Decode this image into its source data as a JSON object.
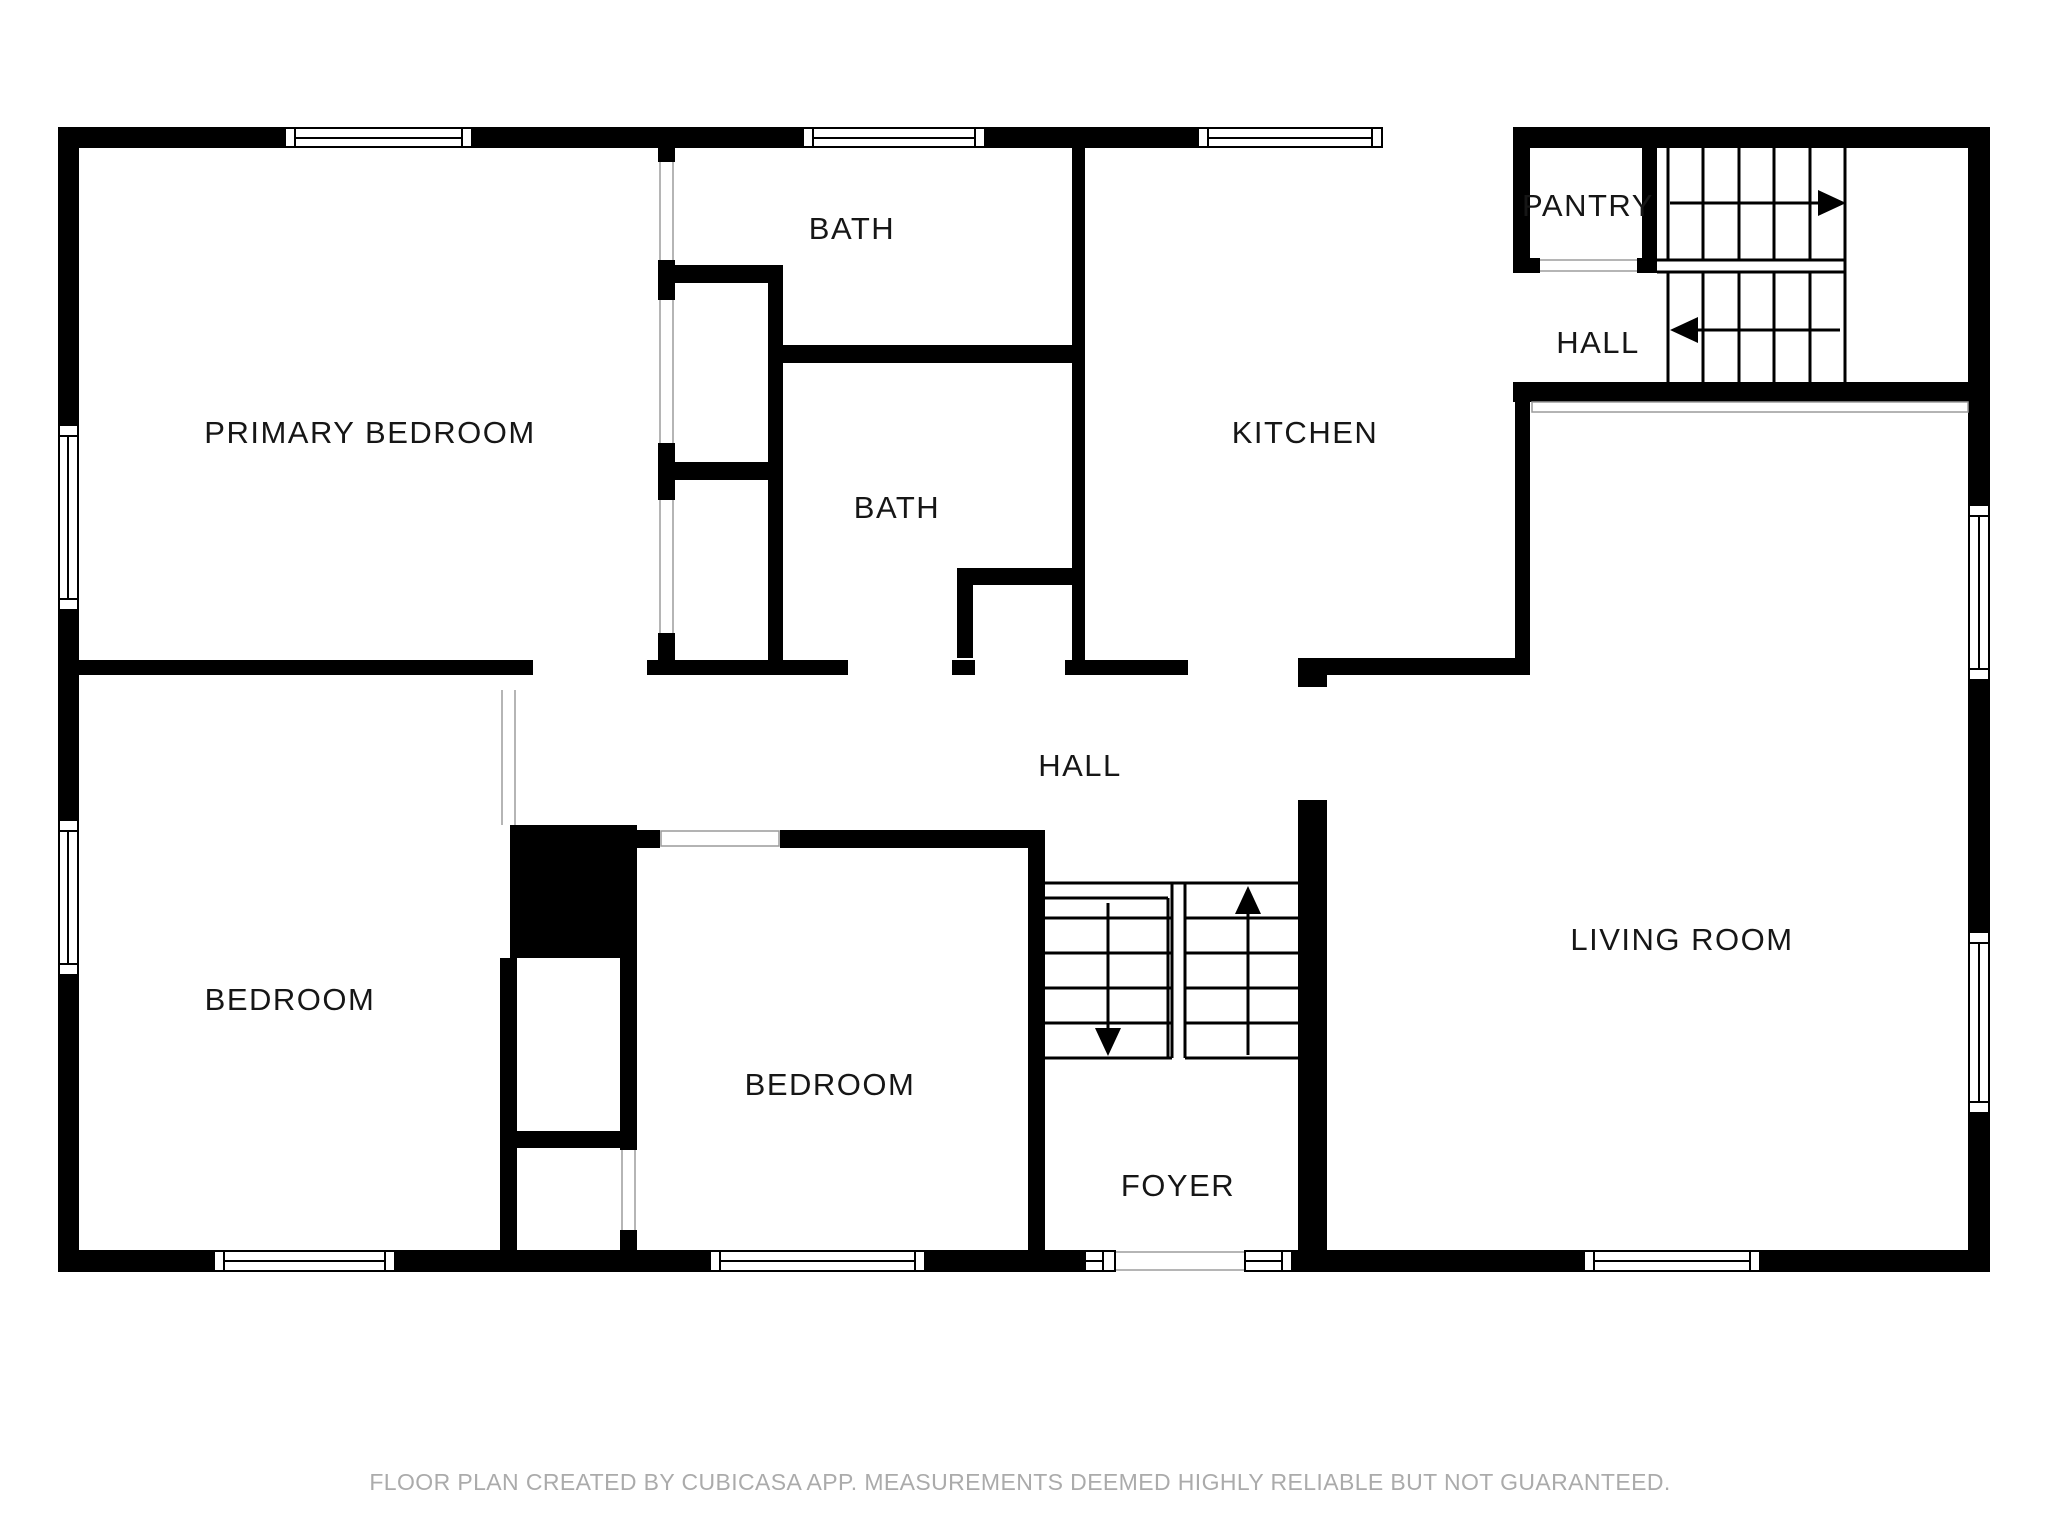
{
  "colors": {
    "background": "#ffffff",
    "wall": "#000000",
    "label": "#161616",
    "footer": "#ababab",
    "opening_line": "#9a9a9a"
  },
  "rooms": {
    "primary_bedroom": {
      "label": "PRIMARY BEDROOM"
    },
    "bath_top": {
      "label": "BATH"
    },
    "bath_middle": {
      "label": "BATH"
    },
    "kitchen": {
      "label": "KITCHEN"
    },
    "pantry": {
      "label": "PANTRY"
    },
    "hall_upper_right": {
      "label": "HALL"
    },
    "hall_middle": {
      "label": "HALL"
    },
    "bedroom_left": {
      "label": "BEDROOM"
    },
    "bedroom_middle": {
      "label": "BEDROOM"
    },
    "foyer": {
      "label": "FOYER"
    },
    "living_room": {
      "label": "LIVING ROOM"
    }
  },
  "stairs": {
    "upper_right": {
      "flights": 2,
      "up_direction": "right",
      "down_direction": "left"
    },
    "center": {
      "flights": 2,
      "up_direction": "up",
      "down_direction": "down"
    }
  },
  "footer": {
    "text": "FLOOR PLAN CREATED BY CUBICASA APP. MEASUREMENTS DEEMED HIGHLY RELIABLE BUT NOT GUARANTEED."
  }
}
